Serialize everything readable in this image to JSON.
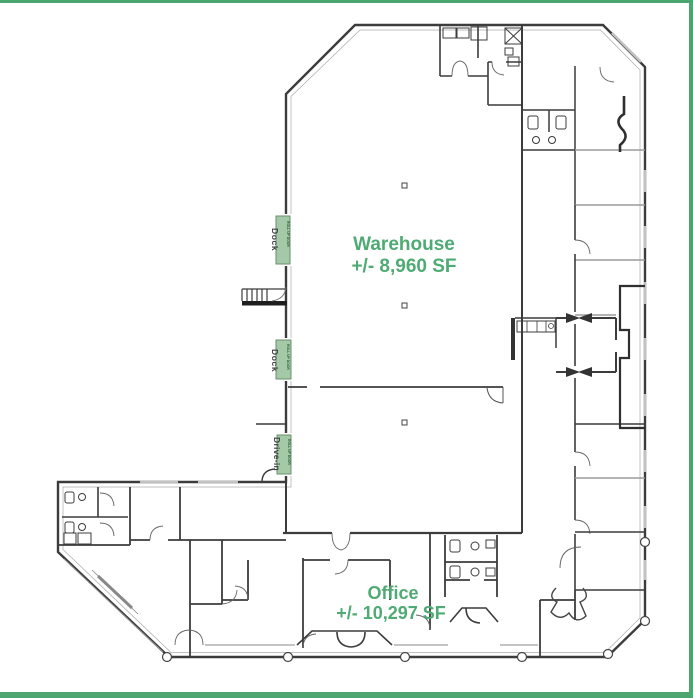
{
  "frame": {
    "color": "#4ba56e"
  },
  "colors": {
    "label_green": "#4fab73",
    "door_fill": "#a3c9a6",
    "door_stroke": "#698f6c",
    "door_text": "#2f5e39",
    "wall_dark": "#3c3c3c",
    "wall_gray": "#9a9a9a",
    "window_gray": "#c2c2c2",
    "dock_text": "#3f3f3f"
  },
  "warehouse": {
    "title": "Warehouse",
    "area": "+/- 8,960 SF"
  },
  "office": {
    "title": "Office",
    "area": "+/- 10,297 SF"
  },
  "doors": {
    "dock1_label": "Dock",
    "dock2_label": "Dock",
    "drive_in_label": "Drive-in",
    "door_tag": "ROLL UP DOOR"
  }
}
